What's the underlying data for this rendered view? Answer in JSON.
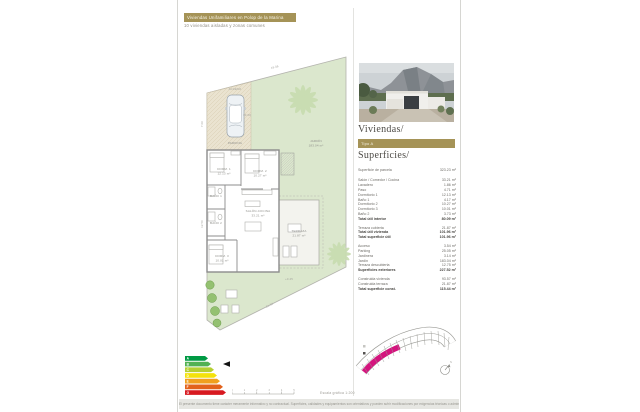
{
  "colors": {
    "accent_gold": "#a59357",
    "magenta": "#d4147e",
    "garden_green": "#dbe7cd",
    "driveway_beige": "#eae3d0"
  },
  "header": {
    "banner": "Viviendas Unifamiliares en Polop de la Marina",
    "subtitle": "10 viviendas aisladas y zonas comunes"
  },
  "right": {
    "viviendas_title": "Viviendas/",
    "type_label": "Tipo A",
    "superficies_title": "Superficies/"
  },
  "superficies": {
    "sections": [
      {
        "rows": [
          {
            "label": "Superficie de parcela",
            "value": "323.23 m²",
            "bold": false
          }
        ]
      },
      {
        "rows": [
          {
            "label": "Salón / Comedor / Cocina",
            "value": "33.21 m²",
            "bold": false
          },
          {
            "label": "Lavadero",
            "value": "1.86 m²",
            "bold": false
          },
          {
            "label": "Paso",
            "value": "4.71 m²",
            "bold": false
          },
          {
            "label": "Dormitorio 1",
            "value": "12.13 m²",
            "bold": false
          },
          {
            "label": "Baño 1",
            "value": "4.17 m²",
            "bold": false
          },
          {
            "label": "Dormitorio 2",
            "value": "10.27 m²",
            "bold": false
          },
          {
            "label": "Dormitorio 3",
            "value": "10.01 m²",
            "bold": false
          },
          {
            "label": "Baño 2",
            "value": "3.73 m²",
            "bold": false
          },
          {
            "label": "Total útil interior",
            "value": "80.09 m²",
            "bold": true
          }
        ]
      },
      {
        "rows": [
          {
            "label": "Terraza cubierta",
            "value": "21.87 m²",
            "bold": false
          },
          {
            "label": "Total útil vivienda",
            "value": "101.96 m²",
            "bold": true
          },
          {
            "label": "Total superficie útil",
            "value": "101.96 m²",
            "bold": true
          }
        ]
      },
      {
        "rows": [
          {
            "label": "Acceso",
            "value": "3.54 m²",
            "bold": false
          },
          {
            "label": "Parking",
            "value": "25.05 m²",
            "bold": false
          },
          {
            "label": "Jardinera",
            "value": "3.14 m²",
            "bold": false
          },
          {
            "label": "Jardín",
            "value": "183.04 m²",
            "bold": false
          },
          {
            "label": "Terraza descubierta",
            "value": "12.75 m²",
            "bold": false
          },
          {
            "label": "Superficies exteriores",
            "value": "227.52 m²",
            "bold": true
          }
        ]
      },
      {
        "rows": [
          {
            "label": "Construida vivienda",
            "value": "93.57 m²",
            "bold": false
          },
          {
            "label": "Construida terraza",
            "value": "21.87 m²",
            "bold": false
          },
          {
            "label": "Total superficie const.",
            "value": "115.44 m²",
            "bold": true
          }
        ]
      }
    ]
  },
  "plan": {
    "labels": [
      {
        "x": 39,
        "y": 116,
        "text": "DORM. 1"
      },
      {
        "x": 39,
        "y": 120.5,
        "text": "12.13 m²"
      },
      {
        "x": 75,
        "y": 118,
        "text": "DORM. 2"
      },
      {
        "x": 75,
        "y": 122.5,
        "text": "10.27 m²"
      },
      {
        "x": 31,
        "y": 143,
        "text": "BAÑO 1"
      },
      {
        "x": 31,
        "y": 170,
        "text": "BAÑO 2"
      },
      {
        "x": 37,
        "y": 203,
        "text": "DORM. 3"
      },
      {
        "x": 37,
        "y": 207.5,
        "text": "10.01 m²"
      },
      {
        "x": 73,
        "y": 158,
        "text": "SALÓN-COCINA"
      },
      {
        "x": 73,
        "y": 162.5,
        "text": "33.21 m²"
      },
      {
        "x": 114,
        "y": 178,
        "text": "TERRAZA"
      },
      {
        "x": 114,
        "y": 182.5,
        "text": "21.87 m²"
      },
      {
        "x": 50,
        "y": 90,
        "text": "PARKING"
      },
      {
        "x": 131,
        "y": 88,
        "text": "JARDÍN"
      },
      {
        "x": 131,
        "y": 92.5,
        "text": "183.04 m²"
      },
      {
        "x": 50,
        "y": 36,
        "text": "ACCESO",
        "cls": "pdim"
      },
      {
        "x": 18,
        "y": 70,
        "text": "7.06",
        "rot": -90,
        "cls": "pdim"
      },
      {
        "x": 18,
        "y": 170,
        "text": "12.50",
        "rot": -90,
        "cls": "pdim"
      },
      {
        "x": 90,
        "y": 14,
        "text": "16.06",
        "rot": -14.5,
        "cls": "pdim"
      },
      {
        "x": 85,
        "y": 252,
        "text": "21.50",
        "rot": -26,
        "cls": "pdim"
      },
      {
        "x": 104,
        "y": 226,
        "text": "+0.45",
        "cls": "pdim"
      },
      {
        "x": 62,
        "y": 62,
        "text": "±0.00",
        "cls": "pdim"
      }
    ]
  },
  "energy": {
    "bars": [
      {
        "letter": "A",
        "width": 20,
        "color": "#009a44"
      },
      {
        "letter": "B",
        "width": 23,
        "color": "#52b153"
      },
      {
        "letter": "C",
        "width": 26,
        "color": "#b5cf32"
      },
      {
        "letter": "D",
        "width": 29,
        "color": "#f4e20b"
      },
      {
        "letter": "E",
        "width": 32,
        "color": "#f0a01e"
      },
      {
        "letter": "F",
        "width": 35,
        "color": "#e2621b"
      },
      {
        "letter": "G",
        "width": 38,
        "color": "#d71920"
      }
    ],
    "marker_row": 1
  },
  "scalebar": {
    "numbers": [
      "0",
      "1",
      "2",
      "3",
      "4",
      "5"
    ],
    "label": "Escala gráfica 1:200"
  },
  "compass": {
    "label": "N"
  },
  "footer": {
    "text": "El presente documento tiene carácter meramente informativo y no contractual. Superficies, calidades y equipamientos son orientativos y pueden sufrir modificaciones por exigencias técnicas o administrativas."
  }
}
